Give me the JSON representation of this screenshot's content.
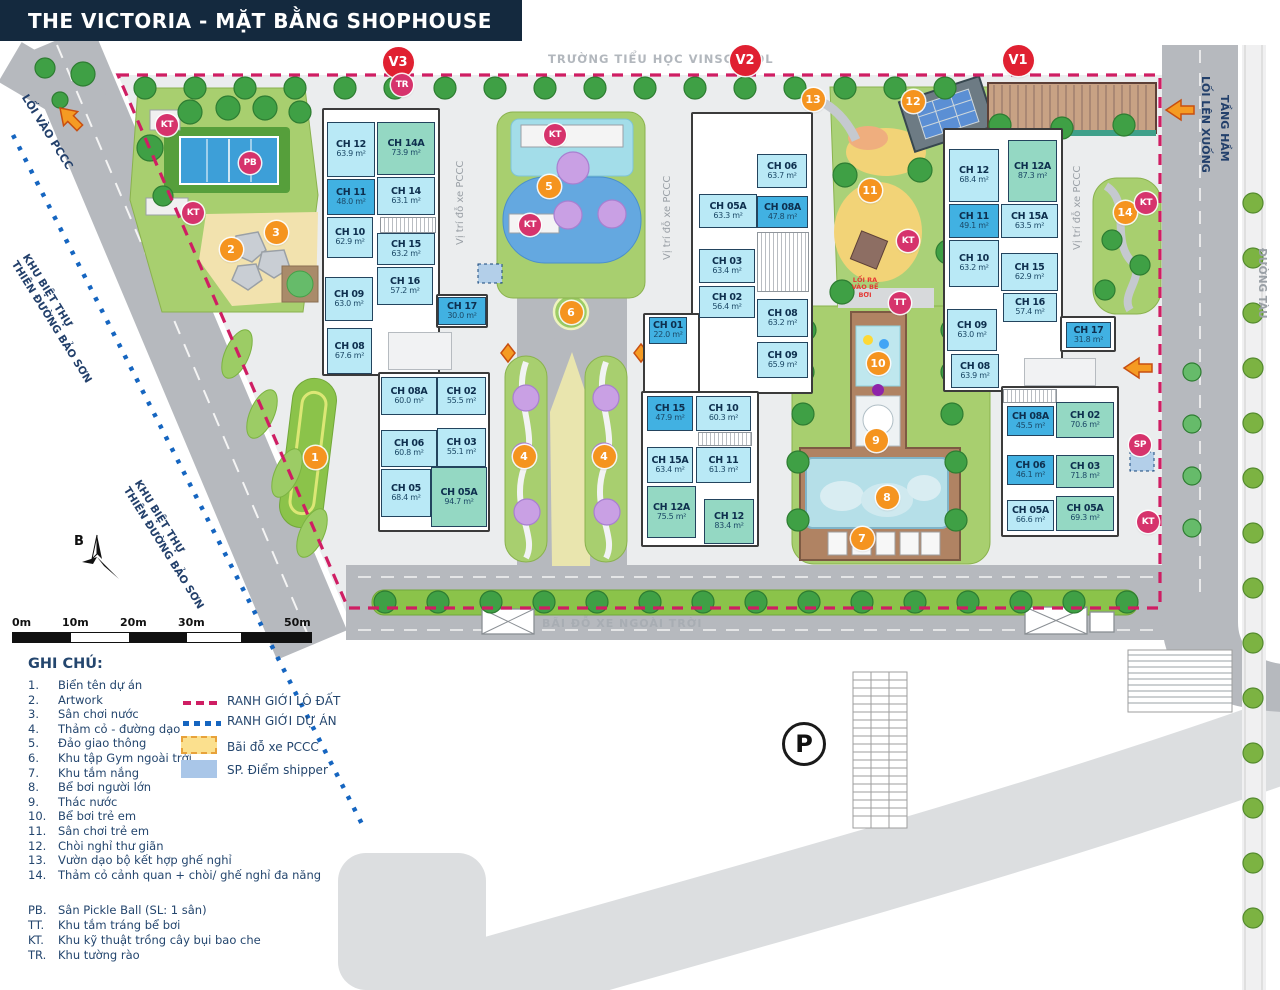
{
  "title": "THE VICTORIA - MẶT BẰNG SHOPHOUSE",
  "top": {
    "school_label": "TRƯỜNG TIỂU HỌC VINSCHOOL"
  },
  "parking": {
    "symbol": "P"
  },
  "compass": {
    "letter": "B"
  },
  "colors": {
    "header_bg": "#14293e",
    "unit_light": "#b9e9f6",
    "unit_dark": "#41b1e2",
    "unit_green": "#94d8c3",
    "marker_orange": "#f5941f",
    "marker_crimson": "#d6336c",
    "block_red": "#e02031",
    "boundary_lot": "#cf1e63",
    "boundary_project": "#1565c0",
    "pccc_box": "#fbe08e",
    "shipper_box": "#a9c6e8"
  },
  "side_labels": {
    "loi_vao_pccc": "LỐI VÀO PCCC",
    "khu_biet_thu": "KHU BIỆT THỰ",
    "thien_duong_bao_son": "THIÊN ĐƯỜNG BẢO SƠN",
    "loi_len_xuong": "LỐI LÊN XUỐNG",
    "tang_ham": "TẦNG HẦM",
    "duong_tau": "ĐƯỜNG TÀU",
    "vi_tri_do_xe": "Vị trí đỗ xe PCCC",
    "bai_do_xe": "BÃI ĐỖ XE NGOÀI TRỜI",
    "loi_ra_vao_be_boi": "LỐI RA VÀO BỂ BƠI"
  },
  "buildings": [
    {
      "id": "V3",
      "units": [
        {
          "label": "CH 12",
          "area": "63.9 m²",
          "type": "light",
          "x": 327,
          "y": 122,
          "w": 48,
          "h": 55
        },
        {
          "label": "CH 14A",
          "area": "73.9 m²",
          "type": "green",
          "x": 377,
          "y": 122,
          "w": 58,
          "h": 53
        },
        {
          "label": "CH 11",
          "area": "48.0 m²",
          "type": "dark",
          "x": 327,
          "y": 179,
          "w": 48,
          "h": 36
        },
        {
          "label": "CH 14",
          "area": "63.1 m²",
          "type": "light",
          "x": 377,
          "y": 177,
          "w": 58,
          "h": 38
        },
        {
          "label": "CH 10",
          "area": "62.9 m²",
          "type": "light",
          "x": 327,
          "y": 217,
          "w": 46,
          "h": 41
        },
        {
          "label": "CH 15",
          "area": "63.2 m²",
          "type": "light",
          "x": 377,
          "y": 233,
          "w": 58,
          "h": 32
        },
        {
          "label": "CH 16",
          "area": "57.2 m²",
          "type": "light",
          "x": 377,
          "y": 267,
          "w": 56,
          "h": 38
        },
        {
          "label": "CH 09",
          "area": "63.0 m²",
          "type": "light",
          "x": 325,
          "y": 277,
          "w": 48,
          "h": 44
        },
        {
          "label": "CH 17",
          "area": "30.0 m²",
          "type": "dark",
          "x": 438,
          "y": 297,
          "w": 48,
          "h": 28
        },
        {
          "label": "CH 08",
          "area": "67.6 m²",
          "type": "light",
          "x": 327,
          "y": 328,
          "w": 45,
          "h": 46
        },
        {
          "label": "CH 08A",
          "area": "60.0 m²",
          "type": "light",
          "x": 381,
          "y": 377,
          "w": 56,
          "h": 38
        },
        {
          "label": "CH 02",
          "area": "55.5 m²",
          "type": "light",
          "x": 437,
          "y": 377,
          "w": 49,
          "h": 38
        },
        {
          "label": "CH 06",
          "area": "60.8 m²",
          "type": "light",
          "x": 381,
          "y": 430,
          "w": 56,
          "h": 37
        },
        {
          "label": "CH 03",
          "area": "55.1 m²",
          "type": "light",
          "x": 437,
          "y": 428,
          "w": 49,
          "h": 39
        },
        {
          "label": "CH 05",
          "area": "68.4 m²",
          "type": "light",
          "x": 381,
          "y": 469,
          "w": 50,
          "h": 48
        },
        {
          "label": "CH 05A",
          "area": "94.7 m²",
          "type": "green",
          "x": 431,
          "y": 467,
          "w": 56,
          "h": 60
        }
      ]
    },
    {
      "id": "V2",
      "units": [
        {
          "label": "CH 06",
          "area": "63.7 m²",
          "type": "light",
          "x": 757,
          "y": 154,
          "w": 50,
          "h": 34
        },
        {
          "label": "CH 05A",
          "area": "63.3 m²",
          "type": "light",
          "x": 699,
          "y": 194,
          "w": 58,
          "h": 34
        },
        {
          "label": "CH 08A",
          "area": "47.8 m²",
          "type": "dark",
          "x": 757,
          "y": 196,
          "w": 51,
          "h": 32
        },
        {
          "label": "CH 03",
          "area": "63.4 m²",
          "type": "light",
          "x": 699,
          "y": 249,
          "w": 56,
          "h": 34
        },
        {
          "label": "CH 02",
          "area": "56.4 m²",
          "type": "light",
          "x": 699,
          "y": 286,
          "w": 56,
          "h": 32
        },
        {
          "label": "CH 08",
          "area": "63.2 m²",
          "type": "light",
          "x": 757,
          "y": 299,
          "w": 51,
          "h": 38
        },
        {
          "label": "CH 09",
          "area": "65.9 m²",
          "type": "light",
          "x": 757,
          "y": 342,
          "w": 51,
          "h": 36
        },
        {
          "label": "CH 01",
          "area": "22.0 m²",
          "type": "dark",
          "x": 649,
          "y": 317,
          "w": 38,
          "h": 27
        },
        {
          "label": "CH 15",
          "area": "47.9 m²",
          "type": "dark",
          "x": 647,
          "y": 396,
          "w": 46,
          "h": 35
        },
        {
          "label": "CH 10",
          "area": "60.3 m²",
          "type": "light",
          "x": 696,
          "y": 396,
          "w": 55,
          "h": 35
        },
        {
          "label": "CH 15A",
          "area": "63.4 m²",
          "type": "light",
          "x": 647,
          "y": 447,
          "w": 46,
          "h": 36
        },
        {
          "label": "CH 11",
          "area": "61.3 m²",
          "type": "light",
          "x": 696,
          "y": 447,
          "w": 55,
          "h": 36
        },
        {
          "label": "CH 12A",
          "area": "75.5 m²",
          "type": "green",
          "x": 647,
          "y": 486,
          "w": 49,
          "h": 52
        },
        {
          "label": "CH 12",
          "area": "83.4 m²",
          "type": "green",
          "x": 704,
          "y": 499,
          "w": 50,
          "h": 45
        }
      ]
    },
    {
      "id": "V1",
      "units": [
        {
          "label": "CH 12",
          "area": "68.4 m²",
          "type": "light",
          "x": 949,
          "y": 149,
          "w": 50,
          "h": 53
        },
        {
          "label": "CH 12A",
          "area": "87.3 m²",
          "type": "green",
          "x": 1008,
          "y": 140,
          "w": 49,
          "h": 62
        },
        {
          "label": "CH 11",
          "area": "49.1 m²",
          "type": "dark",
          "x": 949,
          "y": 204,
          "w": 50,
          "h": 34
        },
        {
          "label": "CH 15A",
          "area": "63.5 m²",
          "type": "light",
          "x": 1001,
          "y": 204,
          "w": 57,
          "h": 34
        },
        {
          "label": "CH 10",
          "area": "63.2 m²",
          "type": "light",
          "x": 949,
          "y": 240,
          "w": 50,
          "h": 47
        },
        {
          "label": "CH 15",
          "area": "62.9 m²",
          "type": "light",
          "x": 1001,
          "y": 253,
          "w": 57,
          "h": 38
        },
        {
          "label": "CH 16",
          "area": "57.4 m²",
          "type": "light",
          "x": 1003,
          "y": 293,
          "w": 54,
          "h": 29
        },
        {
          "label": "CH 09",
          "area": "63.0 m²",
          "type": "light",
          "x": 947,
          "y": 309,
          "w": 50,
          "h": 42
        },
        {
          "label": "CH 08",
          "area": "63.9 m²",
          "type": "light",
          "x": 951,
          "y": 354,
          "w": 48,
          "h": 34
        },
        {
          "label": "CH 17",
          "area": "31.8 m²",
          "type": "dark",
          "x": 1066,
          "y": 322,
          "w": 45,
          "h": 26
        },
        {
          "label": "CH 08A",
          "area": "45.5 m²",
          "type": "dark",
          "x": 1007,
          "y": 406,
          "w": 47,
          "h": 30
        },
        {
          "label": "CH 02",
          "area": "70.6 m²",
          "type": "green",
          "x": 1056,
          "y": 402,
          "w": 58,
          "h": 36
        },
        {
          "label": "CH 06",
          "area": "46.1 m²",
          "type": "dark",
          "x": 1007,
          "y": 455,
          "w": 47,
          "h": 30
        },
        {
          "label": "CH 03",
          "area": "71.8 m²",
          "type": "green",
          "x": 1056,
          "y": 455,
          "w": 58,
          "h": 33
        },
        {
          "label": "CH 05A",
          "area": "66.6 m²",
          "type": "light",
          "x": 1007,
          "y": 500,
          "w": 47,
          "h": 31
        },
        {
          "label": "CH 05A",
          "area": "69.3 m²",
          "type": "green",
          "x": 1056,
          "y": 496,
          "w": 58,
          "h": 35
        }
      ]
    }
  ],
  "markers": [
    {
      "kind": "block",
      "label": "V3",
      "x": 398,
      "y": 62
    },
    {
      "kind": "block",
      "label": "V2",
      "x": 745,
      "y": 60
    },
    {
      "kind": "block",
      "label": "V1",
      "x": 1018,
      "y": 60
    },
    {
      "kind": "num",
      "label": "1",
      "x": 315,
      "y": 457
    },
    {
      "kind": "num",
      "label": "2",
      "x": 231,
      "y": 249
    },
    {
      "kind": "num",
      "label": "3",
      "x": 276,
      "y": 232
    },
    {
      "kind": "num",
      "label": "4",
      "x": 524,
      "y": 456
    },
    {
      "kind": "num",
      "label": "4",
      "x": 604,
      "y": 456
    },
    {
      "kind": "num",
      "label": "5",
      "x": 549,
      "y": 186
    },
    {
      "kind": "num",
      "label": "6",
      "x": 571,
      "y": 312
    },
    {
      "kind": "num",
      "label": "7",
      "x": 862,
      "y": 538
    },
    {
      "kind": "num",
      "label": "8",
      "x": 887,
      "y": 497
    },
    {
      "kind": "num",
      "label": "9",
      "x": 876,
      "y": 440
    },
    {
      "kind": "num",
      "label": "10",
      "x": 878,
      "y": 363
    },
    {
      "kind": "num",
      "label": "11",
      "x": 870,
      "y": 190
    },
    {
      "kind": "num",
      "label": "12",
      "x": 913,
      "y": 101
    },
    {
      "kind": "num",
      "label": "13",
      "x": 813,
      "y": 99
    },
    {
      "kind": "num",
      "label": "14",
      "x": 1125,
      "y": 212
    },
    {
      "kind": "let",
      "label": "PB",
      "x": 250,
      "y": 163
    },
    {
      "kind": "let",
      "label": "KT",
      "x": 167,
      "y": 125
    },
    {
      "kind": "let",
      "label": "KT",
      "x": 193,
      "y": 213
    },
    {
      "kind": "let",
      "label": "KT",
      "x": 555,
      "y": 135
    },
    {
      "kind": "let",
      "label": "KT",
      "x": 530,
      "y": 225
    },
    {
      "kind": "let",
      "label": "KT",
      "x": 908,
      "y": 241
    },
    {
      "kind": "let",
      "label": "KT",
      "x": 1146,
      "y": 203
    },
    {
      "kind": "let",
      "label": "KT",
      "x": 1148,
      "y": 522
    },
    {
      "kind": "let",
      "label": "TT",
      "x": 900,
      "y": 303
    },
    {
      "kind": "let",
      "label": "TR",
      "x": 402,
      "y": 85
    },
    {
      "kind": "let",
      "label": "SP",
      "x": 1140,
      "y": 445
    }
  ],
  "legend": {
    "heading": "GHI CHÚ:",
    "items": [
      {
        "num": "1.",
        "text": "Biển tên dự án"
      },
      {
        "num": "2.",
        "text": "Artwork"
      },
      {
        "num": "3.",
        "text": "Sân chơi nước"
      },
      {
        "num": "4.",
        "text": "Thảm cỏ - đường dạo"
      },
      {
        "num": "5.",
        "text": "Đảo giao thông"
      },
      {
        "num": "6.",
        "text": "Khu tập Gym ngoài trời"
      },
      {
        "num": "7.",
        "text": "Khu tắm nắng"
      },
      {
        "num": "8.",
        "text": "Bể bơi người lớn"
      },
      {
        "num": "9.",
        "text": "Thác nước"
      },
      {
        "num": "10.",
        "text": "Bể bơi trẻ em"
      },
      {
        "num": "11.",
        "text": "Sân chơi trẻ em"
      },
      {
        "num": "12.",
        "text": "Chòi nghỉ thư giãn"
      },
      {
        "num": "13.",
        "text": "Vườn dạo bộ kết hợp ghế nghỉ"
      },
      {
        "num": "14.",
        "text": "Thảm cỏ cảnh quan + chòi/ ghế nghỉ đa năng"
      }
    ],
    "letter_items": [
      {
        "num": "PB.",
        "text": "Sân Pickle Ball (SL: 1 sân)"
      },
      {
        "num": "TT.",
        "text": "Khu tắm tráng bể bơi"
      },
      {
        "num": "KT.",
        "text": "Khu kỹ thuật trồng cây bụi bao che"
      },
      {
        "num": "TR.",
        "text": "Khu tường rào"
      }
    ],
    "symbols": [
      {
        "type": "dash-red",
        "label": "RANH GIỚI LÔ ĐẤT"
      },
      {
        "type": "dot-blue",
        "label": "RANH GIỚI DỰ ÁN"
      },
      {
        "type": "box-yellow",
        "label": "Bãi đỗ xe PCCC"
      },
      {
        "type": "box-blue",
        "label": "SP.  Điểm shipper"
      }
    ]
  },
  "scale_bar": {
    "labels": [
      "0m",
      "10m",
      "20m",
      "30m",
      "50m"
    ]
  }
}
